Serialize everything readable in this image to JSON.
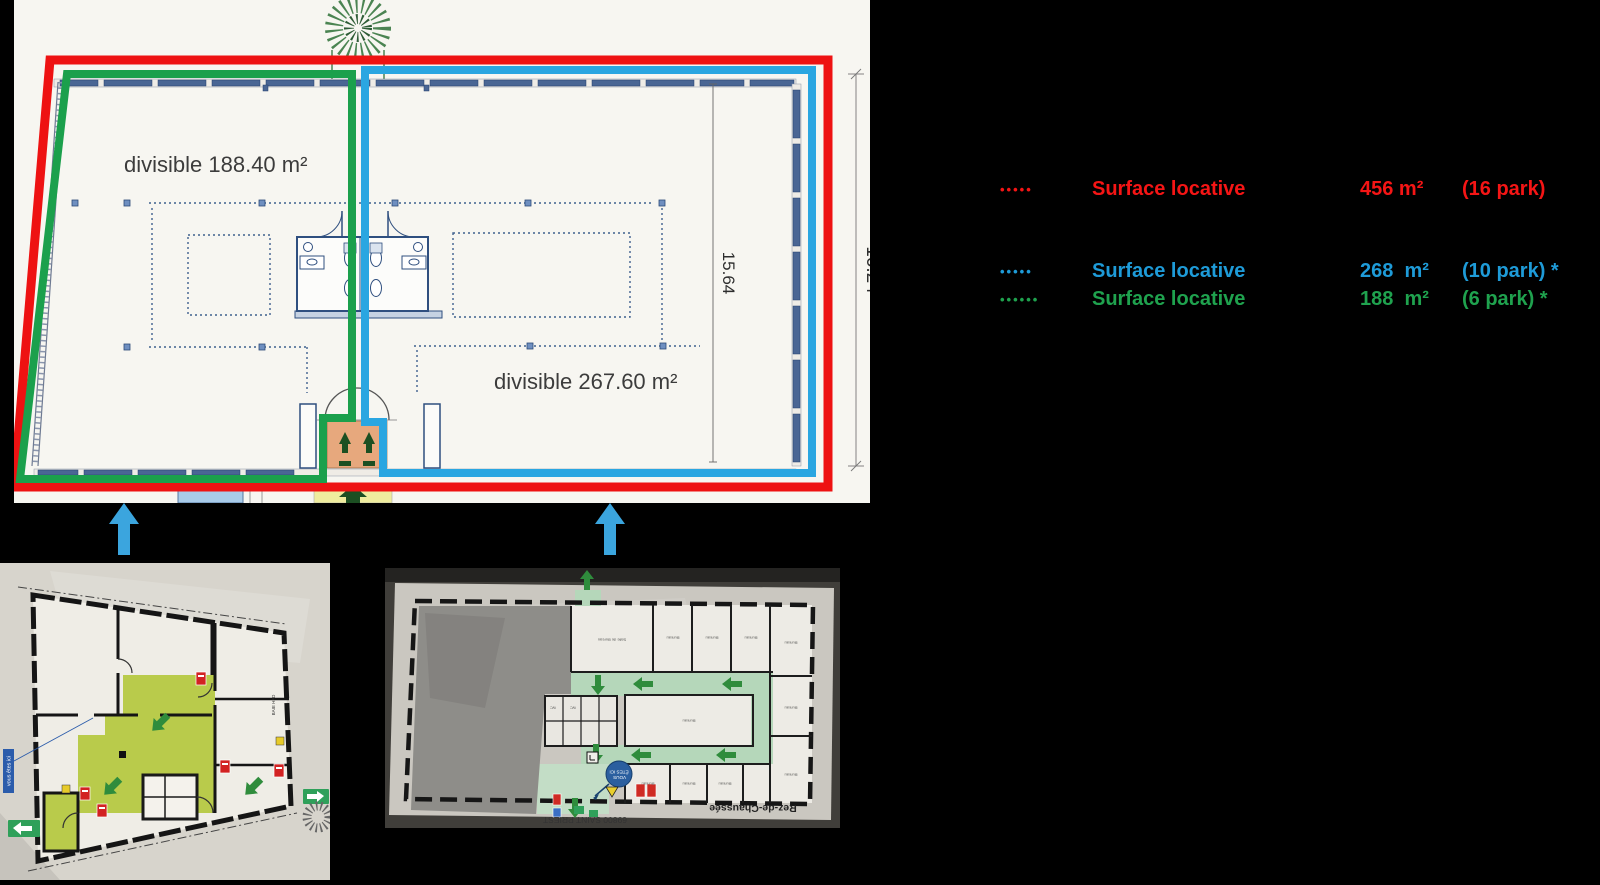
{
  "legend": {
    "rows": [
      {
        "marker": "•••••",
        "label": "Surface locative",
        "area": "456 m²",
        "parking": "(16 park)",
        "color": "#f51515"
      },
      {
        "marker": "•••••",
        "label": "Surface locative",
        "area": "268  m²",
        "parking": "(10 park) *",
        "color": "#1e9bd8"
      },
      {
        "marker": "••••••",
        "label": "Surface locative",
        "area": "188  m²",
        "parking": "(6 park) *",
        "color": "#1fa24e"
      }
    ]
  },
  "floor_plan": {
    "left_room_label": "divisible 188.40 m²",
    "right_room_label": "divisible 267.60 m²",
    "interior_dim": "15.64",
    "exterior_dim": "16.24",
    "outline_colors": {
      "total_red": "#ee1212",
      "blue_lot": "#2aa6e1",
      "green_lot": "#1ba04c"
    }
  },
  "photo_left": {
    "you_are_here_tag": "vous êtes ici",
    "bay_label": "BAIE HFD"
  },
  "photo_right": {
    "badge_line1": "VOUS",
    "badge_line2": "ÊTES ICI",
    "room_label": "Bureau",
    "salle_label": "Salle de Bureau",
    "wc_label": "WC",
    "floor_label": "Rez-de-Chaussée",
    "address_label": "69800 SAINT PRIEST"
  }
}
